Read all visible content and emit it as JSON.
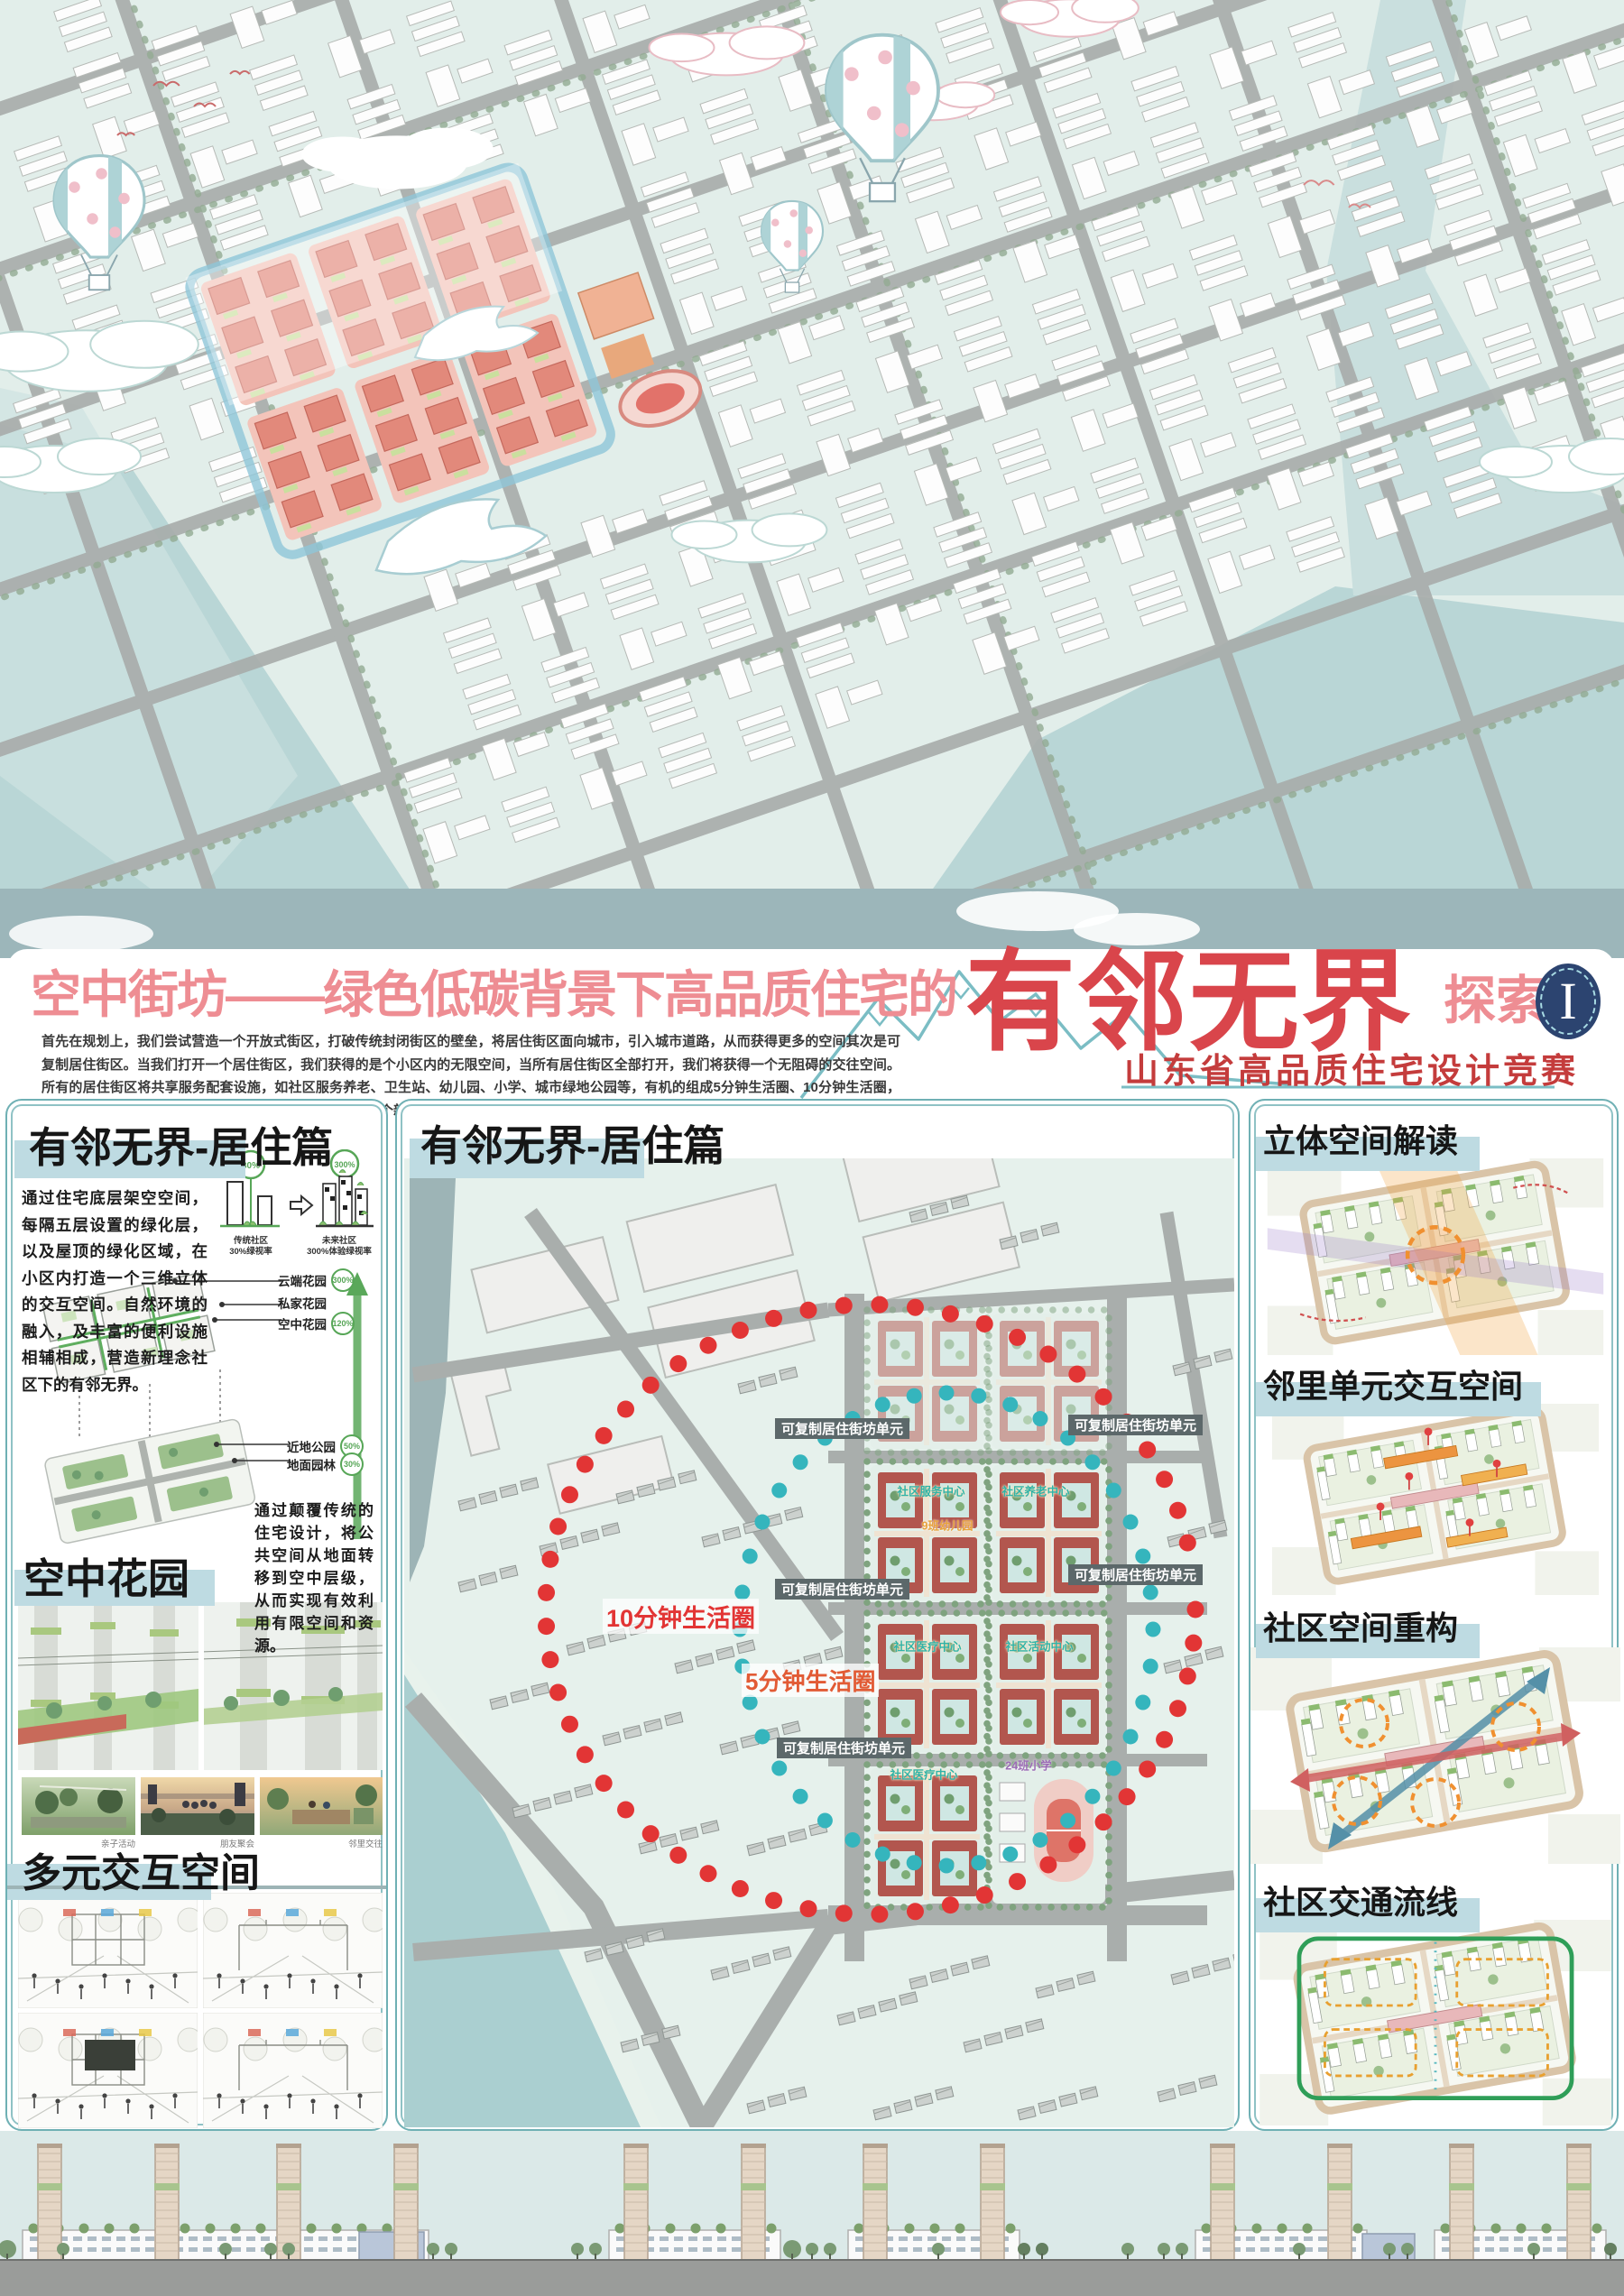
{
  "colors": {
    "title_pink": "#ee8d93",
    "title_red": "#d9454b",
    "competition_red": "#c43c3c",
    "panel_border": "#6fb0b4",
    "header_highlight": "#bedbe2",
    "mint_bg": "#e8f2ee",
    "circle10_red": "#e23535",
    "circle5_teal": "#35b5bd",
    "green": "#57a657",
    "navy_badge": "#2c4470"
  },
  "title": {
    "prefix": "空中街坊——绿色低碳背景下高品质住宅的",
    "highlight": "有邻无界",
    "suffix": "探索",
    "badge": "I",
    "competition": "山东省高品质住宅设计竞赛",
    "intro": "首先在规划上，我们尝试营造一个开放式街区，打破传统封闭街区的壁垒，将居住街区面向城市，引入城市道路，从而获得更多的空间其次是可复制居住街区。当我们打开一个居住街区，我们获得的是个小区内的无限空间，当所有居住街区全部打开，我们将获得一个无阻碍的交往空间。所有的居住街区将共享服务配套设施，如社区服务养老、卫生站、幼儿园、小学、城市绿地公园等，有机的组成5分钟生活圈、10分钟生活圈，这种空间是没有界限。服务配套设施及公共空间将开创一个新的模式，成为邻里交往的促进剂。从而做到规划上的有邻无界。"
  },
  "left_panel": {
    "header": "有邻无界-居住篇",
    "para1": "通过住宅底层架空空间，每隔五层设置的绿化层，以及屋顶的绿化区域，在小区内打造一个三维立体的交互空间。自然环境的融入，及丰富的便利设施相辅相成，营造新理念社区下的有邻无界。",
    "chart": {
      "left_pct": "30%",
      "right_pct": "300%",
      "left_label": "传统社区\n30%绿视率",
      "right_label": "未来社区\n300%体验绿视率"
    },
    "callouts": [
      {
        "label": "云端花园",
        "pct": "300%"
      },
      {
        "label": "私家花园",
        "pct": ""
      },
      {
        "label": "空中花园",
        "pct": "120%"
      },
      {
        "label": "近地公园",
        "pct": "50%"
      },
      {
        "label": "地面园林",
        "pct": "30%"
      }
    ],
    "para2": "通过颠覆传统的住宅设计，将公共空间从地面转移到空中层级，从而实现有效利用有限空间和资源。",
    "header2": "空中花园",
    "photo_captions": [
      "亲子活动",
      "朋友聚会",
      "邻里交往"
    ],
    "header3": "多元交互空间"
  },
  "middle_panel": {
    "header": "有邻无界-居住篇",
    "unit_label": "可复制居住街坊单元",
    "circle10": "10分钟生活圈",
    "circle5": "5分钟生活圈",
    "facilities": {
      "service": "社区服务中心",
      "elder": "社区养老中心",
      "kindergarten": "9班幼儿园",
      "medical": "社区医疗中心",
      "activity": "社区活动中心",
      "medical2": "社区医疗中心",
      "school": "24班小学"
    }
  },
  "right_panel": {
    "sections": [
      {
        "header": "立体空间解读"
      },
      {
        "header": "邻里单元交互空间"
      },
      {
        "header": "社区空间重构"
      },
      {
        "header": "社区交通流线"
      }
    ]
  }
}
